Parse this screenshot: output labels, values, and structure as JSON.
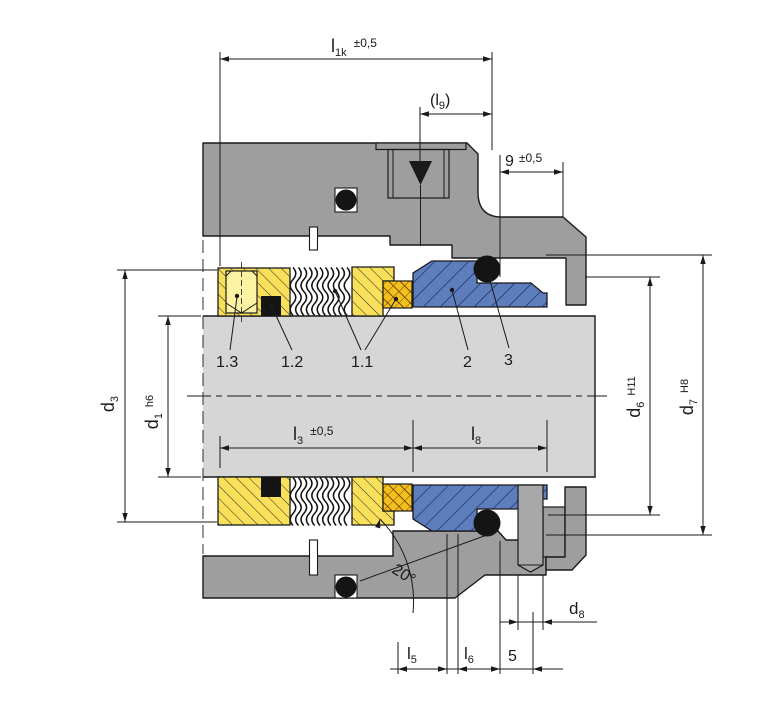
{
  "drawing": {
    "type": "mechanical-seal-cross-section",
    "dims": {
      "l1k": {
        "main": "l",
        "sub": "1k",
        "tol": "±0,5"
      },
      "l9": {
        "open": "(l",
        "sub": "9",
        "close": ")"
      },
      "g9": {
        "main": "9",
        "tol": "±0,5"
      },
      "d3": {
        "main": "d",
        "sub": "3"
      },
      "d1": {
        "main": "d",
        "sub": "1",
        "fit": "h6"
      },
      "l3": {
        "main": "l",
        "sub": "3",
        "tol": "±0,5"
      },
      "l8": {
        "main": "l",
        "sub": "8"
      },
      "d6": {
        "main": "d",
        "sub": "6",
        "fit": "H11"
      },
      "d7": {
        "main": "d",
        "sub": "7",
        "fit": "H8"
      },
      "angle": "20°",
      "d8": {
        "main": "d",
        "sub": "8"
      },
      "l5": {
        "main": "l",
        "sub": "5"
      },
      "l6": {
        "main": "l",
        "sub": "6"
      },
      "five": "5"
    },
    "parts": {
      "p13": "1.3",
      "p12": "1.2",
      "p11": "1.1",
      "p2": "2",
      "p3": "3"
    },
    "colors": {
      "housing": "#9e9e9e",
      "shaft": "#d6d6d6",
      "pin": "#a8a8a8",
      "elastomer_yellow": "#f8e05a",
      "screw_yellow": "#fdf2a2",
      "packing_orange": "#f3c11d",
      "seat_blue": "#5d7dbd",
      "oring_black": "#141414"
    }
  }
}
